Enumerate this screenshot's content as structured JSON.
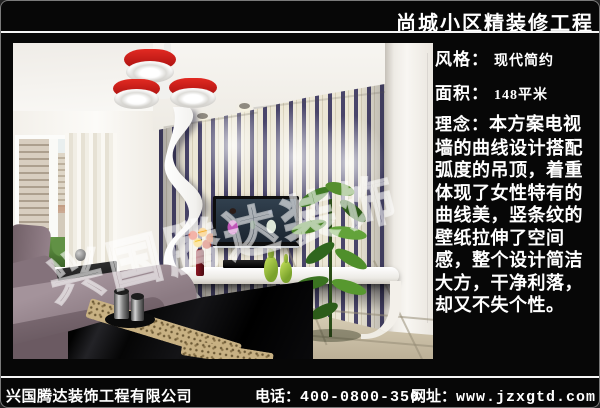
{
  "header": {
    "title": "尚城小区精装修工程"
  },
  "panel": {
    "style_label": "风格：",
    "style_value": "现代简约",
    "area_label": "面积：",
    "area_value": "148平米",
    "concept_label": "理念：",
    "concept_text": "本方案电视墙的曲线设计搭配弧度的吊顶，着重体现了女性特有的曲线美，竖条纹的壁纸拉伸了空间感，整个设计简洁大方，干净利落，却又不失个性。"
  },
  "photo": {
    "watermark": "兴国腾达装饰"
  },
  "footer": {
    "company": "兴国腾达装饰工程有限公司",
    "phone_label": "电话：",
    "phone_number": "400-0800-350",
    "web_label": "网址：",
    "web_url": "www.jzxgtd.com"
  },
  "colors": {
    "accent_red": "#c81e1e",
    "stripe_dark": "#49456a",
    "wall_cream": "#ece7d6",
    "sofa_mauve": "#93818a",
    "plant_green": "#4a8a2a",
    "vase_green": "#9cc83e"
  }
}
